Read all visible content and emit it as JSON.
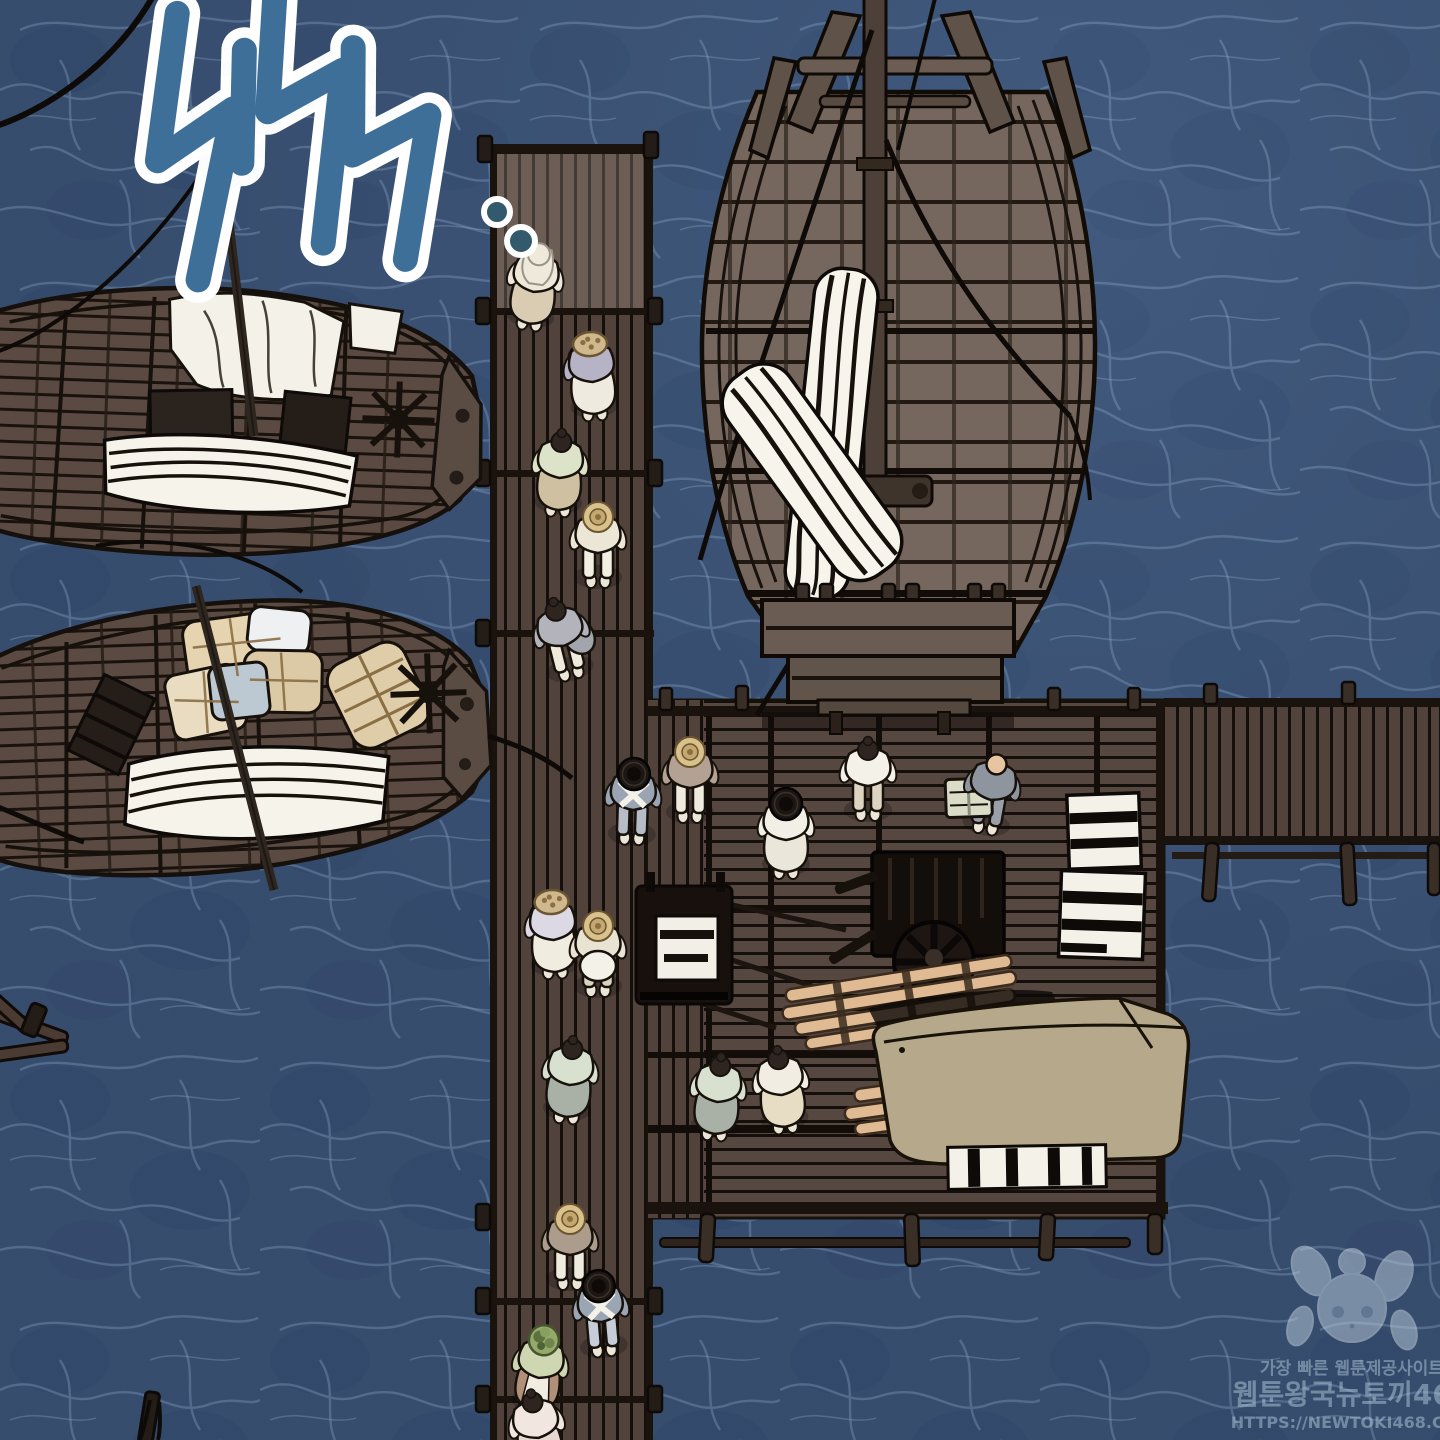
{
  "panel": {
    "width": 1440,
    "height": 1440,
    "type": "webtoon-comic-panel"
  },
  "sfx": {
    "text": "철썩",
    "meaning": "splash sound effect",
    "color": "#3e6f99",
    "outline_color": "#ffffff",
    "trailing_dots": 2,
    "dot_fill": "#33596c"
  },
  "watermark": {
    "tagline": "가장 빠른 웹툰제공사이트",
    "site_name": "웹툰왕국뉴토끼468",
    "url": "HTTPS://NEWTOKI468.COM",
    "color": "#b9d0de",
    "mascot": "rabbit-girl"
  },
  "palette": {
    "water": "#3a5174",
    "water_caustic": "#7e9ab9",
    "water_dark": "#2c4163",
    "pier_wood": "#51433c",
    "dock_wood": "#564740",
    "ship_wood": "#75675e",
    "canvas_tan": "#b5a88b",
    "bundle_tan": "#e0cda9",
    "fabric_white": "#f6f3ea",
    "outline": "#17110c",
    "timber_tan": "#e0ba92"
  },
  "scene": {
    "description": "Top-down view of a wooden harbor: a long plank pier crossing a dock platform, a large moored cargo ship, two moored boats with bundled cargo, and people in hanbok carrying baskets and goods over dark blue water",
    "boats": [
      {
        "id": "boat-top-left",
        "cargo": [
          "white cloth bundles",
          "striped fabric roll",
          "dark crates",
          "spoked wheel",
          "mast and ropes"
        ]
      },
      {
        "id": "boat-bottom-left",
        "cargo": [
          "tan wrapped bundles",
          "blue-gray bundle",
          "wrapped barrel",
          "striped fabric roll",
          "tilted crate",
          "spoked wheel"
        ]
      }
    ],
    "ship": {
      "id": "cargo-ship",
      "features": [
        "center mast",
        "cross beam",
        "stern prongs",
        "rigging ropes",
        "furled striped sails",
        "windlass",
        "stepped stern platforms"
      ]
    },
    "piers": [
      "vertical-pier",
      "dock-platform",
      "right-pier"
    ],
    "dock_cargo": [
      "handcart with white crate",
      "wheeled dark cart",
      "timber pole bundle",
      "large canvas-covered cargo",
      "white slatted crates"
    ],
    "figures": [
      {
        "x": 535,
        "y": 282,
        "rot": 8,
        "hat": "cloth",
        "top": "#eee8da",
        "bottom": "#d9ccb2",
        "skirt": true
      },
      {
        "x": 592,
        "y": 372,
        "rot": -4,
        "hat": "basket",
        "top": "#b7b3c6",
        "bottom": "#eeeae0",
        "skirt": true,
        "armUp": true
      },
      {
        "x": 560,
        "y": 468,
        "rot": 3,
        "hat": "hair",
        "top": "#dde3c8",
        "bottom": "#cfc0a2",
        "skirt": true
      },
      {
        "x": 598,
        "y": 543,
        "rot": 0,
        "hat": "straw",
        "top": "#ece6d6",
        "bottom": "#f2eee2",
        "skirt": false
      },
      {
        "x": 562,
        "y": 636,
        "rot": -14,
        "hat": "hair",
        "top": "#b3b3bb",
        "bottom": "#efeadc",
        "skirt": false,
        "sack": "#a3a5ac"
      },
      {
        "x": 633,
        "y": 800,
        "rot": 2,
        "hat": "gat",
        "top": "#9aa4b2",
        "bottom": "#b7bdc6",
        "skirt": false,
        "sash": true
      },
      {
        "x": 690,
        "y": 778,
        "rot": 0,
        "hat": "straw",
        "top": "#b3a293",
        "bottom": "#efeade",
        "skirt": false
      },
      {
        "x": 553,
        "y": 930,
        "rot": -3,
        "hat": "basket",
        "top": "#dcd8e4",
        "bottom": "#f0ece0",
        "skirt": true,
        "armUp": true
      },
      {
        "x": 598,
        "y": 952,
        "rot": 0,
        "hat": "straw",
        "top": "#e9e3d3",
        "bottom": "#d9d2c0",
        "skirt": false,
        "bundle": "#f4f1e8"
      },
      {
        "x": 786,
        "y": 830,
        "rot": 0,
        "hat": "gat",
        "top": "#f2efe6",
        "bottom": "#eae6da",
        "skirt": true
      },
      {
        "x": 868,
        "y": 776,
        "rot": 0,
        "hat": "hair",
        "top": "#f4f1e8",
        "bottom": "#ddd5c2",
        "skirt": false
      },
      {
        "x": 992,
        "y": 790,
        "rot": 10,
        "hat": "bald",
        "top": "#8f959f",
        "bottom": "#9aa0aa",
        "skirt": false,
        "crate": "#dadcc8"
      },
      {
        "x": 570,
        "y": 1075,
        "rot": 5,
        "hat": "hair",
        "top": "#d8e0d0",
        "bottom": "#a9b0a6",
        "skirt": true
      },
      {
        "x": 718,
        "y": 1092,
        "rot": 5,
        "hat": "hair",
        "top": "#d8e0d0",
        "bottom": "#a9b0a6",
        "skirt": true
      },
      {
        "x": 781,
        "y": 1085,
        "rot": -6,
        "hat": "hair",
        "top": "#f1ede2",
        "bottom": "#e7ddc4",
        "skirt": true
      },
      {
        "x": 570,
        "y": 1245,
        "rot": 0,
        "hat": "straw",
        "top": "#ac9c8b",
        "bottom": "#f0ebdf",
        "skirt": false
      },
      {
        "x": 601,
        "y": 1312,
        "rot": -5,
        "hat": "gat",
        "top": "#9aa6b4",
        "bottom": "#c6cdd6",
        "skirt": false,
        "sash": true
      },
      {
        "x": 540,
        "y": 1368,
        "rot": 8,
        "hat": "greens",
        "top": "#ced6b2",
        "bottom": "#b28f78",
        "skirt": true,
        "apron": "#f1ede1"
      },
      {
        "x": 537,
        "y": 1428,
        "rot": -10,
        "hat": "hair",
        "top": "#f2e7e0",
        "bottom": "#e8d8d2",
        "skirt": true
      }
    ]
  }
}
